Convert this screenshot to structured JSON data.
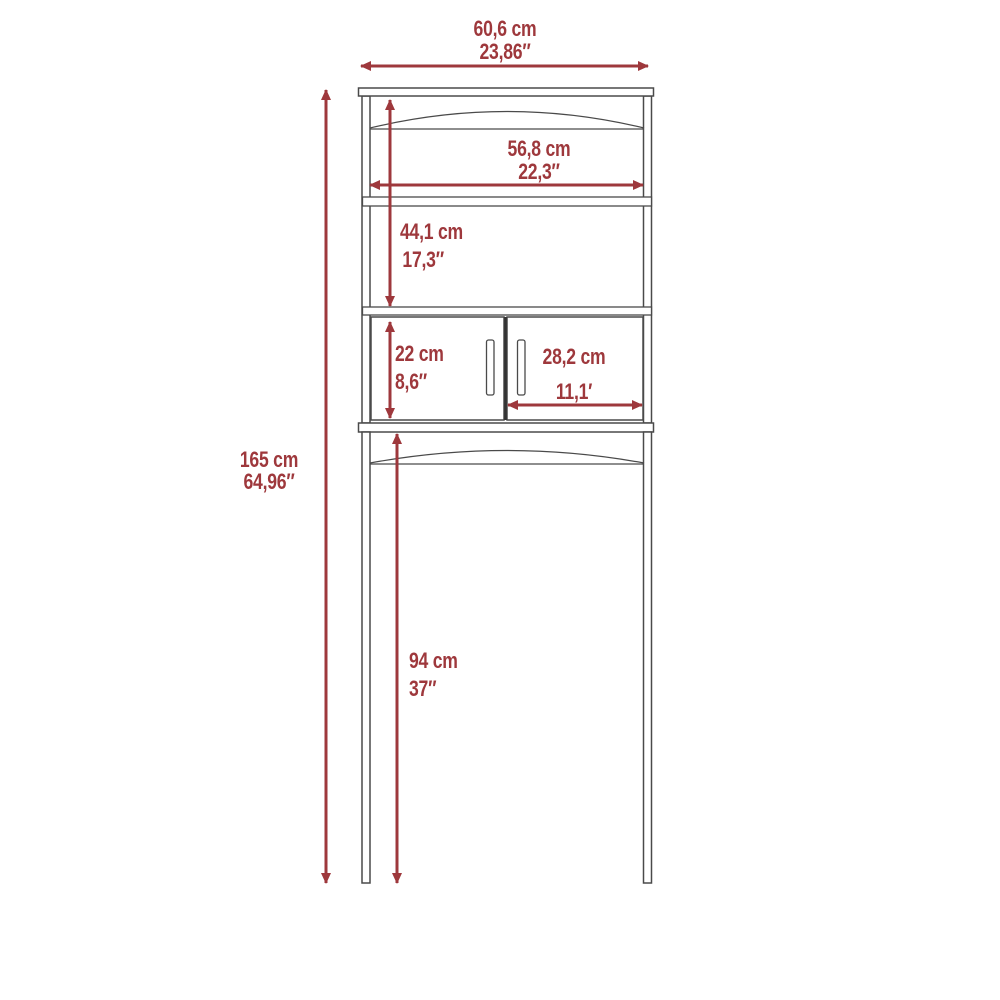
{
  "colors": {
    "accent": "#9e383c",
    "line": "#4a4a4a",
    "divider": "#333333",
    "background": "#ffffff"
  },
  "dims": {
    "overall_width": {
      "cm": "60,6 cm",
      "inch": "23,86″"
    },
    "overall_height": {
      "cm": "165 cm",
      "inch": "64,96″"
    },
    "shelf_width": {
      "cm": "56,8 cm",
      "inch": "22,3″"
    },
    "upper_section_height": {
      "cm": "44,1 cm",
      "inch": "17,3″"
    },
    "door_height": {
      "cm": "22 cm",
      "inch": "8,6″"
    },
    "door_width": {
      "cm": "28,2 cm",
      "inch": "11,1′"
    },
    "clearance_height": {
      "cm": "94 cm",
      "inch": "37″"
    }
  }
}
